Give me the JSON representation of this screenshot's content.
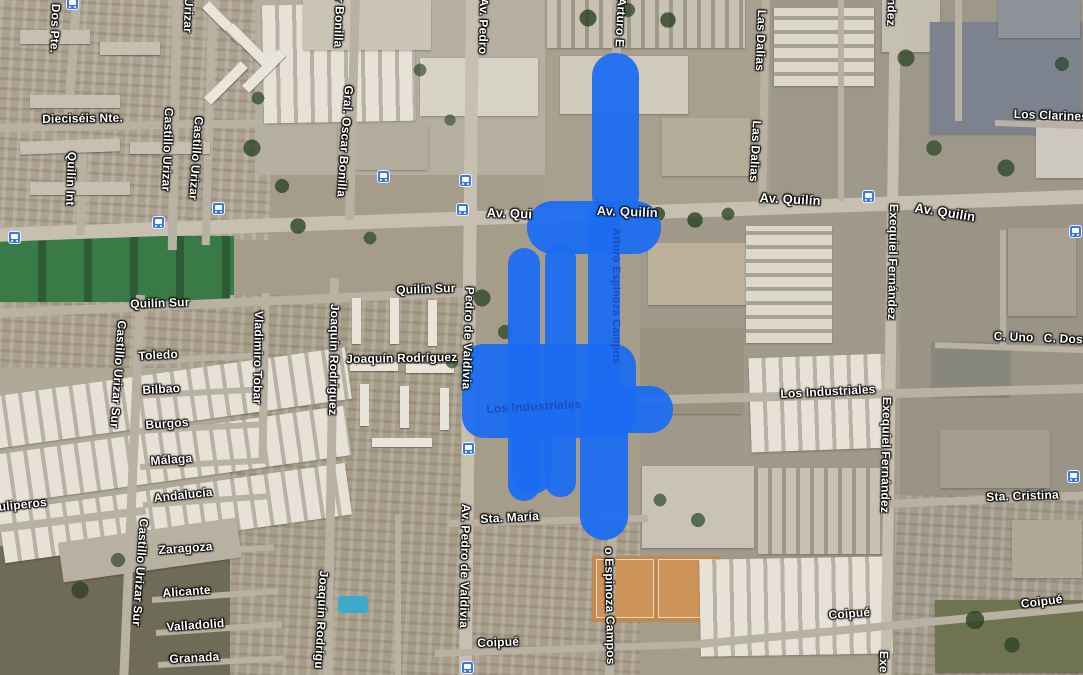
{
  "map": {
    "type": "satellite-map",
    "region": "Quilín / Macul area street map",
    "highlight": {
      "color": "#1c6cf2",
      "name": "selected-streets-highlight",
      "shapes": [
        {
          "x": 592,
          "y": 53,
          "w": 47,
          "h": 165,
          "r": 23
        },
        {
          "x": 527,
          "y": 201,
          "w": 134,
          "h": 53,
          "r": 26
        },
        {
          "x": 588,
          "y": 208,
          "w": 32,
          "h": 195,
          "r": 4
        },
        {
          "x": 508,
          "y": 248,
          "w": 32,
          "h": 253,
          "r": 16
        },
        {
          "x": 545,
          "y": 244,
          "w": 31,
          "h": 253,
          "r": 15
        },
        {
          "x": 462,
          "y": 344,
          "w": 174,
          "h": 94,
          "r": 22
        },
        {
          "x": 598,
          "y": 386,
          "w": 75,
          "h": 47,
          "r": 23
        },
        {
          "x": 513,
          "y": 400,
          "w": 39,
          "h": 94,
          "r": 19
        },
        {
          "x": 580,
          "y": 390,
          "w": 48,
          "h": 150,
          "r": 24
        }
      ]
    },
    "street_labels": [
      {
        "text": "Dos Pte.",
        "x": 63,
        "y": 4,
        "rot": 92
      },
      {
        "text": "Dieciséis Nte.",
        "x": 42,
        "y": 112,
        "rot": -1
      },
      {
        "text": "Quilín Int",
        "x": 79,
        "y": 152,
        "rot": 92
      },
      {
        "text": "Urizar",
        "x": 196,
        "y": -2,
        "rot": 92
      },
      {
        "text": "Castillo Urizar",
        "x": 176,
        "y": 108,
        "rot": 92
      },
      {
        "text": "Castillo Urizar",
        "x": 206,
        "y": 117,
        "rot": 94
      },
      {
        "text": "Quilín Sur",
        "x": 130,
        "y": 297,
        "rot": -2
      },
      {
        "text": "Quilín Sur",
        "x": 396,
        "y": 283,
        "rot": -2
      },
      {
        "text": "r Bonilla",
        "x": 347,
        "y": -2,
        "rot": 92
      },
      {
        "text": "Gral. Oscar Bonilla",
        "x": 356,
        "y": 86,
        "rot": 94
      },
      {
        "text": "Av. Pedro",
        "x": 491,
        "y": -2,
        "rot": 91
      },
      {
        "text": "Arturo E",
        "x": 629,
        "y": -2,
        "rot": 93
      },
      {
        "text": "Las Dalias",
        "x": 769,
        "y": 10,
        "rot": 92
      },
      {
        "text": "Las Dalias",
        "x": 764,
        "y": 121,
        "rot": 93
      },
      {
        "text": "ndez",
        "x": 899,
        "y": -2,
        "rot": 92
      },
      {
        "text": "Av. Quilín",
        "x": 916,
        "y": 200,
        "rot": 9,
        "size": 13
      },
      {
        "text": "Av. Quilín",
        "x": 760,
        "y": 190,
        "rot": 3,
        "size": 13
      },
      {
        "text": "Av. Qui",
        "x": 487,
        "y": 205,
        "rot": 2,
        "size": 13
      },
      {
        "text": "Av. Quilín",
        "x": 597,
        "y": 203,
        "rot": 2,
        "size": 13,
        "style": "overlay"
      },
      {
        "text": "Los Clarines",
        "x": 1014,
        "y": 107,
        "rot": 2
      },
      {
        "text": "Exequiel Fernández",
        "x": 901,
        "y": 204,
        "rot": 91
      },
      {
        "text": "Exequiel Fernández",
        "x": 894,
        "y": 397,
        "rot": 91
      },
      {
        "text": "Exe",
        "x": 891,
        "y": 651,
        "rot": 91
      },
      {
        "text": "C. Uno",
        "x": 994,
        "y": 329,
        "rot": 2
      },
      {
        "text": "C. Dos",
        "x": 1044,
        "y": 331,
        "rot": 2
      },
      {
        "text": "Los Industriales",
        "x": 780,
        "y": 387,
        "rot": -3
      },
      {
        "text": "Los Industriales",
        "x": 486,
        "y": 402,
        "rot": -3,
        "style": "faint"
      },
      {
        "text": "Arturo Espinoza Campos",
        "x": 622,
        "y": 228,
        "rot": 90,
        "style": "faint",
        "size": 11
      },
      {
        "text": "Vladimiro Tobar",
        "x": 266,
        "y": 311,
        "rot": 91
      },
      {
        "text": "Joaquín Rodríguez",
        "x": 342,
        "y": 304,
        "rot": 91
      },
      {
        "text": "Joaquín Rodríguez",
        "x": 346,
        "y": 352,
        "rot": -1
      },
      {
        "text": "Toledo",
        "x": 138,
        "y": 349,
        "rot": -3
      },
      {
        "text": "Bilbao",
        "x": 142,
        "y": 383,
        "rot": -3
      },
      {
        "text": "Burgos",
        "x": 145,
        "y": 418,
        "rot": -4
      },
      {
        "text": "Málaga",
        "x": 150,
        "y": 454,
        "rot": -4
      },
      {
        "text": "Andalucía",
        "x": 153,
        "y": 491,
        "rot": -6
      },
      {
        "text": "uliperos",
        "x": -2,
        "y": 500,
        "rot": -6
      },
      {
        "text": "Castillo Urizar Sur",
        "x": 129,
        "y": 321,
        "rot": 94
      },
      {
        "text": "Zaragoza",
        "x": 158,
        "y": 543,
        "rot": -4
      },
      {
        "text": "Alicante",
        "x": 162,
        "y": 586,
        "rot": -4
      },
      {
        "text": "Valladolid",
        "x": 166,
        "y": 620,
        "rot": -4
      },
      {
        "text": "Granada",
        "x": 169,
        "y": 652,
        "rot": -3
      },
      {
        "text": "Castillo Urizar Sur",
        "x": 151,
        "y": 519,
        "rot": 94
      },
      {
        "text": "Pedro de Valdivia",
        "x": 477,
        "y": 287,
        "rot": 92
      },
      {
        "text": "Av. Pedro de Valdivia",
        "x": 473,
        "y": 504,
        "rot": 91
      },
      {
        "text": "Sta. María",
        "x": 480,
        "y": 512,
        "rot": -3
      },
      {
        "text": "Coipué",
        "x": 477,
        "y": 636,
        "rot": -2
      },
      {
        "text": "o Espinoza Campos",
        "x": 616,
        "y": 547,
        "rot": 89
      },
      {
        "text": "Joaquín Rodrígu",
        "x": 331,
        "y": 571,
        "rot": 93
      },
      {
        "text": "Sta. Cristina",
        "x": 986,
        "y": 490,
        "rot": -2
      },
      {
        "text": "Coipué",
        "x": 828,
        "y": 608,
        "rot": -4
      },
      {
        "text": "Coipué",
        "x": 1020,
        "y": 597,
        "rot": -7
      }
    ],
    "transit_icons": [
      {
        "x": 66,
        "y": -3
      },
      {
        "x": 8,
        "y": 231
      },
      {
        "x": 152,
        "y": 216
      },
      {
        "x": 212,
        "y": 202
      },
      {
        "x": 377,
        "y": 170
      },
      {
        "x": 459,
        "y": 174
      },
      {
        "x": 456,
        "y": 203
      },
      {
        "x": 462,
        "y": 442
      },
      {
        "x": 461,
        "y": 661
      },
      {
        "x": 862,
        "y": 190
      },
      {
        "x": 1069,
        "y": 225
      },
      {
        "x": 1067,
        "y": 470
      }
    ]
  }
}
